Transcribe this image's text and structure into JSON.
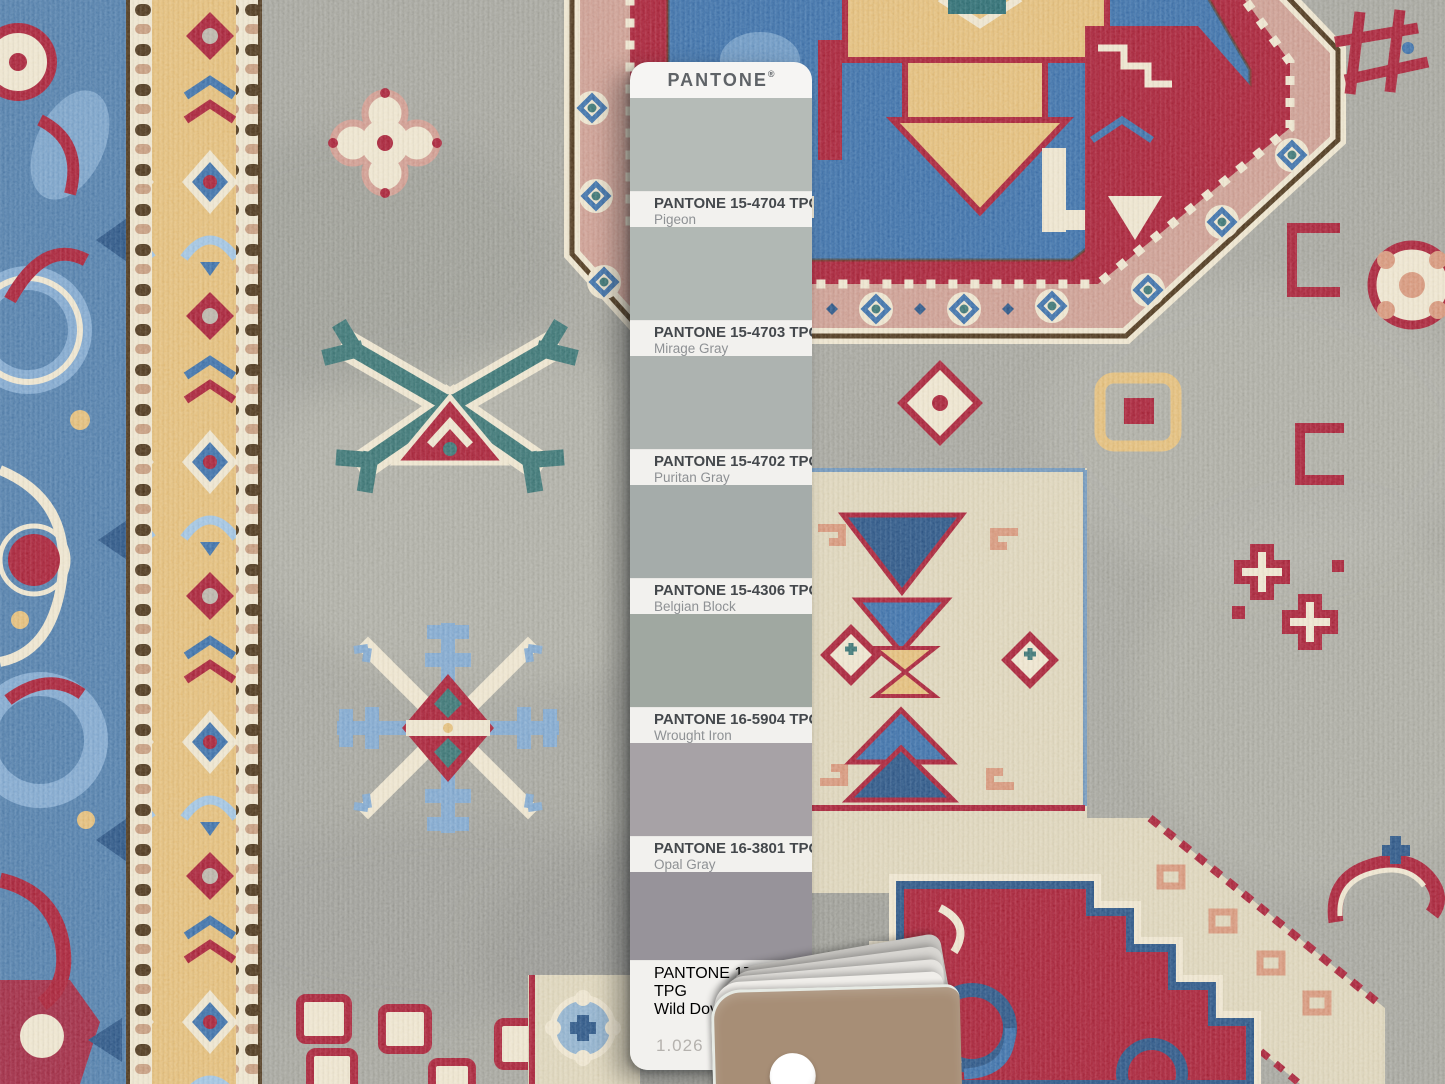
{
  "pantone_card": {
    "brand": "PANTONE",
    "registered_mark": "®",
    "page_number": "1.026",
    "swatches": [
      {
        "code": "PANTONE 15-4704 TPG",
        "name": "Pigeon",
        "hex": "#b5bbb7"
      },
      {
        "code": "PANTONE 15-4703 TPG",
        "name": "Mirage Gray",
        "hex": "#b1b8b4"
      },
      {
        "code": "PANTONE 15-4702 TPG",
        "name": "Puritan Gray",
        "hex": "#adb3b0"
      },
      {
        "code": "PANTONE 15-4306 TPG",
        "name": "Belgian Block",
        "hex": "#a5acaa"
      },
      {
        "code": "PANTONE 16-5904 TPG",
        "name": "Wrought Iron",
        "hex": "#a0a8a1"
      },
      {
        "code": "PANTONE 16-3801 TPG",
        "name": "Opal Gray",
        "hex": "#a7a2a6"
      },
      {
        "code": "PANTONE 17-1501 TPG",
        "name": "Wild Dove",
        "hex": "#97939a"
      }
    ]
  },
  "theme": {
    "card_white": "#f6f5f3",
    "label_white": "#f2f1ee",
    "card_tan": "#a78e76",
    "rug_field": "#a4a49c",
    "rug_field_light": "#b3b3aa",
    "rug_field_dark": "#8f908a",
    "rug_blue_border": "#527da9",
    "rug_blue": "#3e6fa7",
    "rug_blue_light": "#7fa6cd",
    "rug_blue_deep": "#2e5584",
    "rug_red": "#a62539",
    "rug_gold": "#e2bc79",
    "rug_cream": "#ece3cc",
    "rug_ivory": "#dcd3b8",
    "rug_teal": "#3c7372",
    "rug_pink": "#cb9c90",
    "rug_salmon": "#d59579",
    "rug_brown": "#4f3a22"
  }
}
